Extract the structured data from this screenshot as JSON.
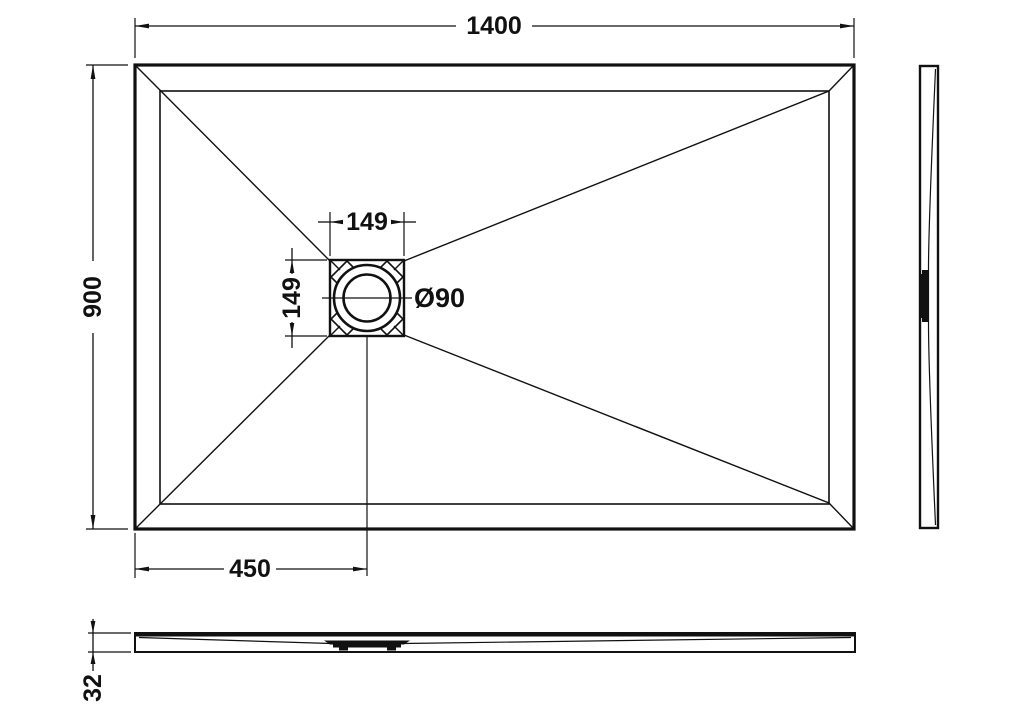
{
  "colors": {
    "line": "#111111",
    "background": "#ffffff"
  },
  "plan_view": {
    "width": "1400",
    "depth": "900",
    "drain_box_width": "149",
    "drain_box_height": "149",
    "drain_diameter": "Ø90",
    "drain_center_offset": "450"
  },
  "profile_view": {
    "thickness": "32"
  }
}
